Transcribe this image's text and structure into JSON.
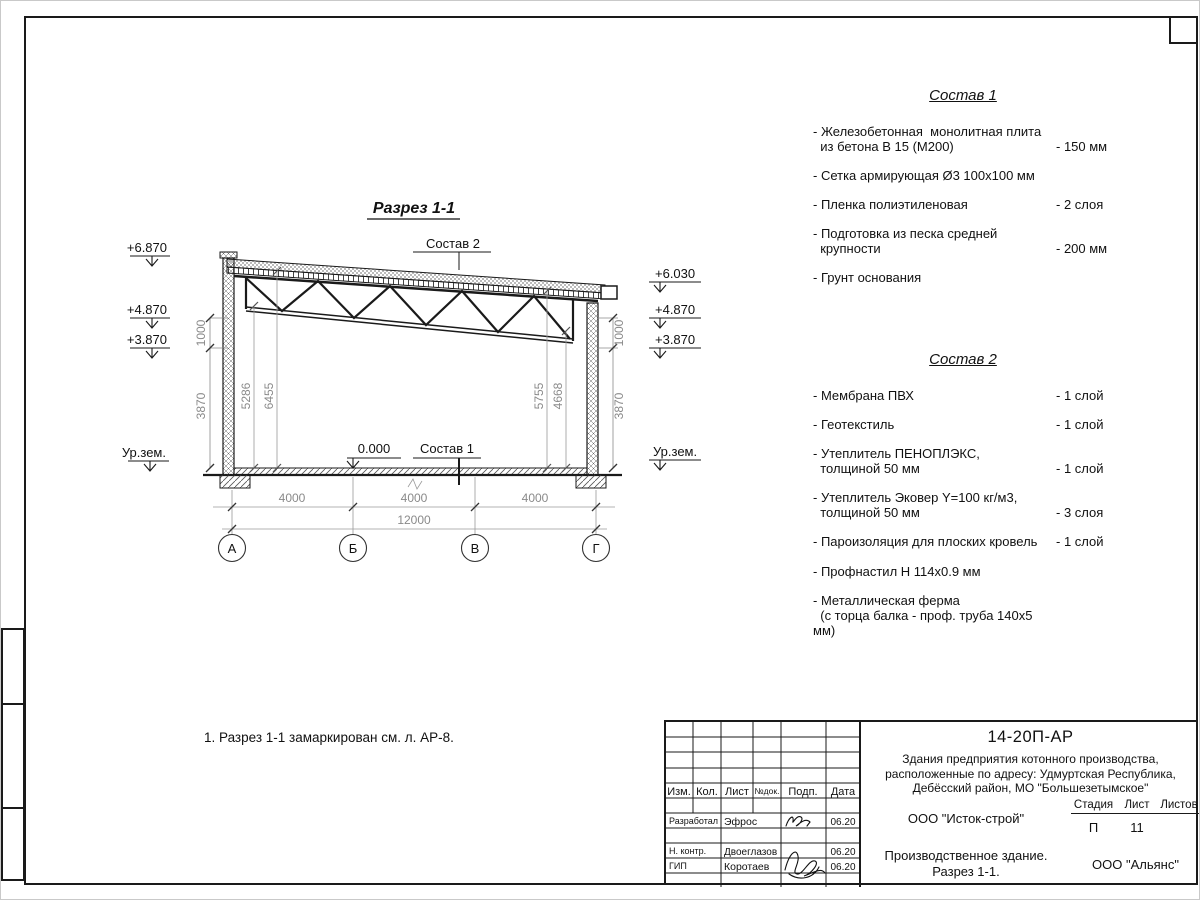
{
  "drawing": {
    "title": "Разрез 1-1",
    "note": "1. Разрез 1-1 замаркирован см. л. АР-8.",
    "labels": {
      "sostav2_ref": "Состав 2",
      "sostav1_ref": "Состав 1",
      "zero_level": "0.000",
      "ground_left": "Ур.зем.",
      "ground_right": "Ур.зем."
    },
    "elevations": {
      "left_top": "+6.870",
      "left_mid": "+4.870",
      "left_low": "+3.870",
      "right_top": "+6.030",
      "right_mid": "+4.870",
      "right_low": "+3.870"
    },
    "dims": {
      "left_parapet": "1000",
      "left_wall": "3870",
      "right_parapet": "1000",
      "right_wall": "3870",
      "inner_left_truss": "5286",
      "inner_left_roof": "6455",
      "inner_right_roof": "5755",
      "inner_right_truss": "4668",
      "bay_1": "4000",
      "bay_2": "4000",
      "bay_3": "4000",
      "total": "12000"
    },
    "axes": {
      "a": "А",
      "b": "Б",
      "v": "В",
      "g": "Г"
    }
  },
  "sostav1": {
    "title": "Состав 1",
    "items": [
      {
        "name": "- Железобетонная  монолитная плита\n  из бетона В 15 (М200)",
        "value": "- 150 мм"
      },
      {
        "name": "- Сетка армирующая Ø3 100х100 мм",
        "value": ""
      },
      {
        "name": "- Пленка полиэтиленовая",
        "value": "-  2 слоя"
      },
      {
        "name": "- Подготовка из песка средней\n  крупности",
        "value": "- 200 мм"
      },
      {
        "name": "- Грунт основания",
        "value": ""
      }
    ]
  },
  "sostav2": {
    "title": "Состав 2",
    "items": [
      {
        "name": "- Мембрана ПВХ",
        "value": "- 1 слой"
      },
      {
        "name": "- Геотекстиль",
        "value": "- 1 слой"
      },
      {
        "name": "- Утеплитель ПЕНОПЛЭКС,\n  толщиной 50 мм",
        "value": "- 1 слой"
      },
      {
        "name": "- Утеплитель Эковер Y=100 кг/м3,\n  толщиной 50 мм",
        "value": "- 3 слоя"
      },
      {
        "name": "- Пароизоляция для плоских кровель",
        "value": "- 1 слой"
      },
      {
        "name": "- Профнастил Н 114х0.9 мм",
        "value": ""
      },
      {
        "name": "- Металлическая ферма\n  (с торца балка - проф. труба 140х5 мм)",
        "value": ""
      }
    ]
  },
  "titleblock": {
    "doc_number": "14-20П-АР",
    "project_description": "Здания предприятия котонного производства,\nрасположенные по адресу: Удмуртская Республика,\nДебёсский район, МО \"Большезетымское\"",
    "headers": {
      "izm": "Изм.",
      "kol": "Кол.",
      "list": "Лист",
      "ndok": "№док.",
      "podp": "Подп.",
      "data": "Дата"
    },
    "staff": [
      {
        "role": "Разработал",
        "name": "Эфрос",
        "date": "06.20"
      },
      {
        "role": "Н. контр.",
        "name": "Двоеглазов",
        "date": "06.20"
      },
      {
        "role": "ГИП",
        "name": "Коротаев",
        "date": "06.20"
      }
    ],
    "design_org": "ООО \"Исток-строй\"",
    "stage_header": "Стадия",
    "sheet_header": "Лист",
    "sheets_header": "Листов",
    "stage": "П",
    "sheet_number": "11",
    "sheets_total": "",
    "object_title": "Производственное здание.\nРазрез 1-1.",
    "customer_org": "ООО \"Альянс\""
  }
}
